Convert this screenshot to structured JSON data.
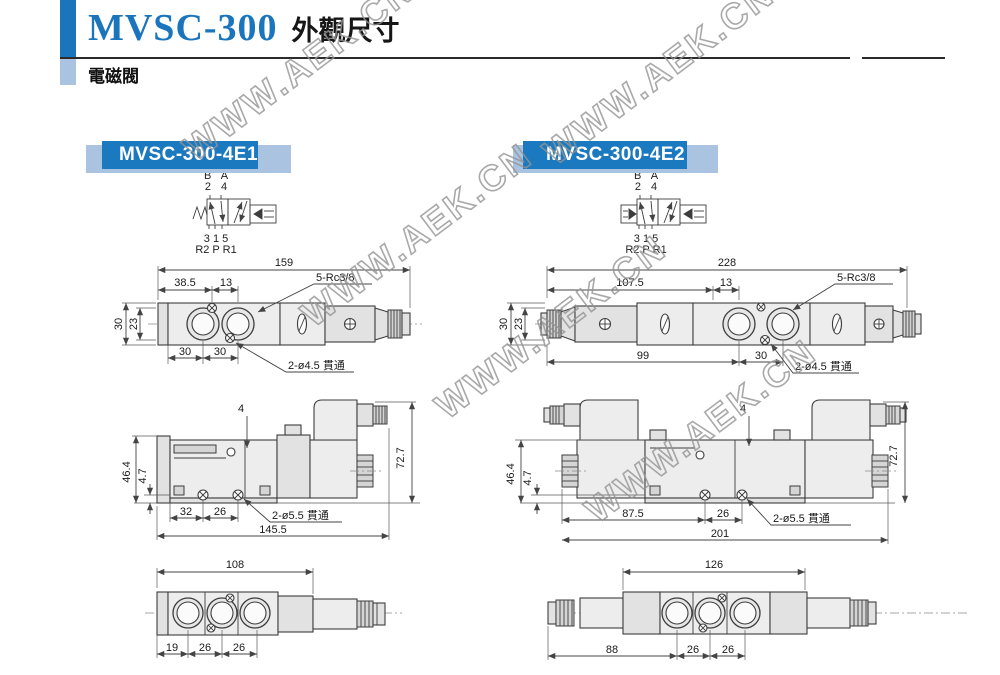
{
  "page": {
    "model": "MVSC-300",
    "title_suffix": "外觀尺寸",
    "subtitle": "電磁閥",
    "watermark": "WWW.AEK.CN"
  },
  "colors": {
    "accent_blue": "#1b75bc",
    "light_blue": "#a9c3e0",
    "header_box_blue": "#1b79bf",
    "drawing_fill": "#ededed",
    "line": "#3d3d3d"
  },
  "sections": [
    {
      "label": "MVSC-300-4E1",
      "symbol": {
        "row1": "B A",
        "row2": "2 4",
        "row3": "3 1 5",
        "row4": "R2 P R1"
      },
      "top": {
        "overall": "159",
        "d1": "38.5",
        "d2": "13",
        "thread": "5-Rc3/8",
        "side1": "30",
        "side2": "23",
        "b1": "30",
        "b2": "30",
        "hole": "2-ø4.5 貫通"
      },
      "side": {
        "t": "4",
        "r": "72.7",
        "v1": "46.4",
        "v2": "4.7",
        "b1": "32",
        "b2": "26",
        "hole": "2-ø5.5 貫通",
        "overall": "145.5"
      },
      "bottom": {
        "overall": "108",
        "b1": "19",
        "b2": "26",
        "b3": "26"
      }
    },
    {
      "label": "MVSC-300-4E2",
      "symbol": {
        "row1": "B A",
        "row2": "2 4",
        "row3": "3 1 5",
        "row4": "R2 P R1"
      },
      "top": {
        "overall": "228",
        "d1": "107.5",
        "d2": "13",
        "thread": "5-Rc3/8",
        "side1": "30",
        "side2": "23",
        "b1": "99",
        "b2": "30",
        "hole": "2-ø4.5 貫通"
      },
      "side": {
        "t": "4",
        "r": "72.7",
        "v1": "46.4",
        "v2": "4.7",
        "b1": "87.5",
        "b2": "26",
        "hole": "2-ø5.5 貫通",
        "overall": "201"
      },
      "bottom": {
        "overall": "126",
        "b1": "88",
        "b2": "26",
        "b3": "26"
      }
    }
  ]
}
